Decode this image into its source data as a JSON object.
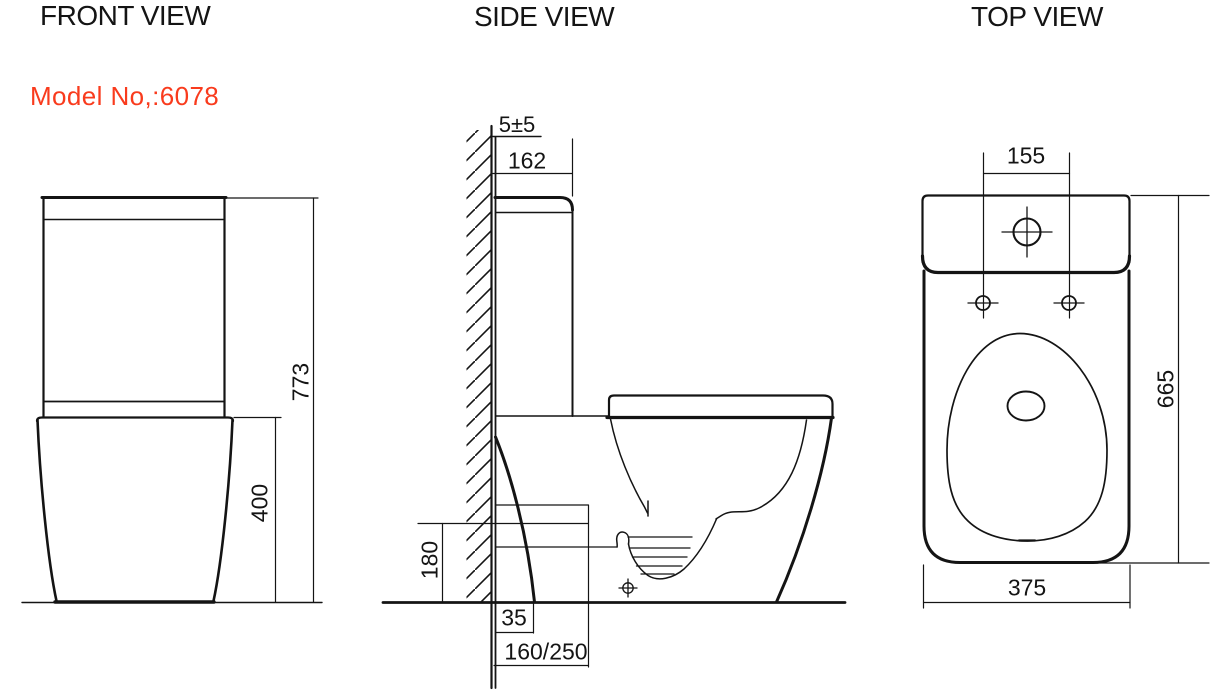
{
  "canvas": {
    "background": "#ffffff",
    "line_color": "#141414",
    "accent_color": "#f93b1d"
  },
  "front_view": {
    "title": "FRONT VIEW",
    "model_label": "Model No,:6078",
    "dims": {
      "overall_height": "773",
      "bowl_height": "400"
    }
  },
  "side_view": {
    "title": "SIDE VIEW",
    "dims": {
      "wall_gap": "5±5",
      "tank_depth": "162",
      "outlet_height": "180",
      "foot_clearance": "35",
      "trap_setout": "160/250"
    }
  },
  "top_view": {
    "title": "TOP VIEW",
    "dims": {
      "tank_hole_spacing": "155",
      "overall_depth": "665",
      "overall_width": "375"
    }
  }
}
